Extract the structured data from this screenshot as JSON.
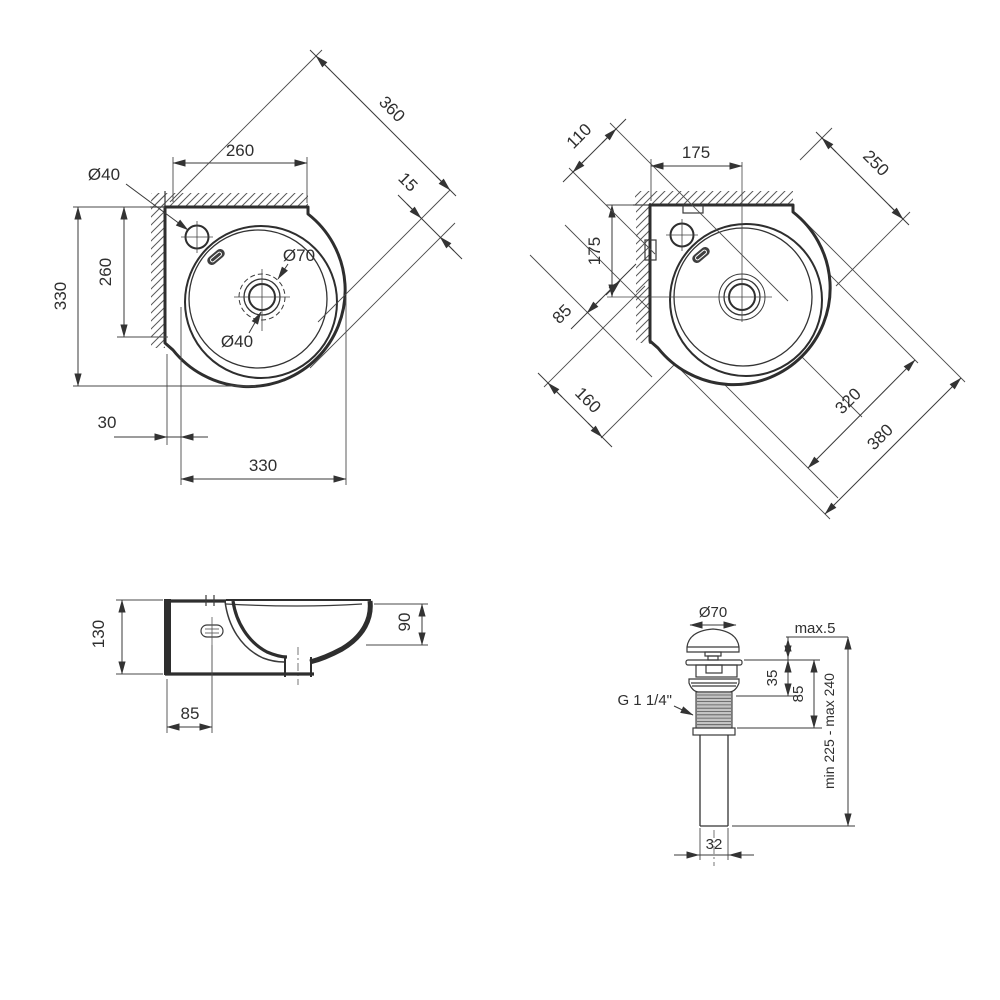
{
  "colors": {
    "line": "#3a3a3a",
    "text": "#2f2f2f",
    "background": "#ffffff"
  },
  "top_view": {
    "width_top": "260",
    "diag": "360",
    "rim_front": "15",
    "faucet_hole": "Ø40",
    "height_left": "330",
    "depth_left": "260",
    "drain_outer": "Ø70",
    "drain_hole": "Ø40",
    "wall_offset": "30",
    "width_bottom": "330"
  },
  "diagonal_view": {
    "hole_spacing": "110",
    "offset_x": "175",
    "edge_top": "250",
    "offset_y": "175",
    "edge_left": "85",
    "front_left": "160",
    "bowl_width": "320",
    "overall_width": "380"
  },
  "side_view": {
    "height": "130",
    "depth_right": "90",
    "faucet_offset": "85"
  },
  "drain_view": {
    "cap_diameter": "Ø70",
    "deck_max": "max.5",
    "cap_height": "35",
    "body_height": "85",
    "thread": "G 1 1/4\"",
    "length_range": "min 225 - max 240",
    "pipe_diameter": "32"
  }
}
